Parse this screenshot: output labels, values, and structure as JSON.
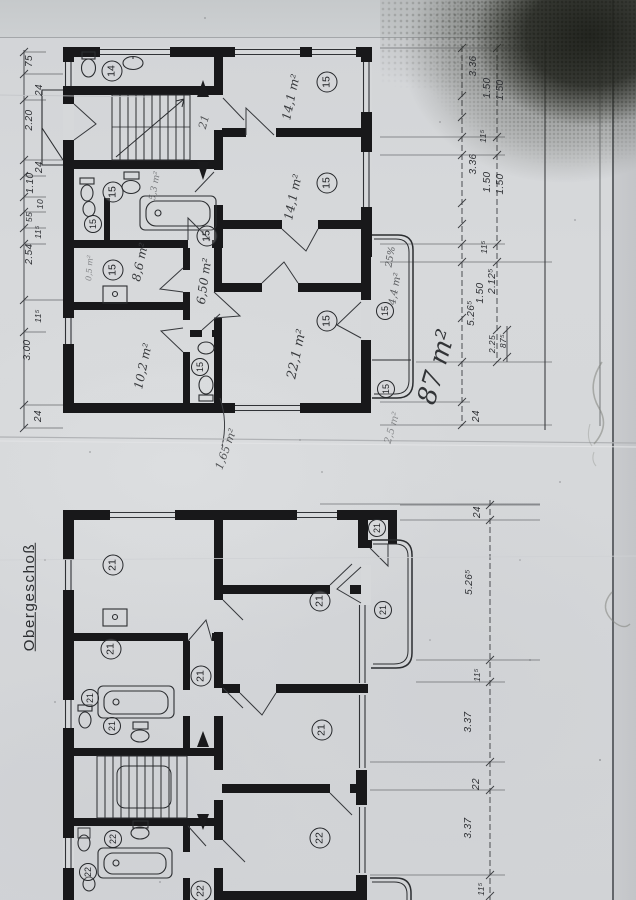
{
  "labels": {
    "floor": "Obergeschoß"
  },
  "top_plan": {
    "unit_area": "87 m²",
    "vestibule_note": "21",
    "circles": [
      "14",
      "15",
      "15",
      "15",
      "15",
      "15",
      "15",
      "15",
      "15",
      "15",
      "15"
    ],
    "areas": [
      "14,1 m²",
      "14,1 m²",
      "22,1 m²",
      "8,6 m²",
      "6,50 m²",
      "10,2 m²",
      "1,65 m²",
      "25%",
      "4,4 m²",
      "0,5 m²",
      "5,3 m²",
      "2,5 m²"
    ],
    "dims_left": [
      "75",
      "24",
      "2.20",
      "24",
      "1.10",
      "10",
      "55",
      "11⁵",
      "2.54",
      "11⁵",
      "3.00",
      "24"
    ],
    "dims_right": [
      "3.36",
      "1.50",
      "1.50",
      "11⁵",
      "3.36",
      "1.50",
      "1.50",
      "11⁵",
      "2.12⁵",
      "1.50",
      "5.26⁵",
      "87⁵",
      "2.25",
      "24"
    ]
  },
  "bottom_plan": {
    "circles": [
      "21",
      "21",
      "21",
      "21",
      "21",
      "21",
      "21",
      "21",
      "21",
      "22",
      "22",
      "22",
      "22"
    ],
    "dims_right": [
      "24",
      "5.26⁵",
      "11⁵",
      "3.37",
      "22",
      "3.37",
      "11⁵"
    ]
  }
}
